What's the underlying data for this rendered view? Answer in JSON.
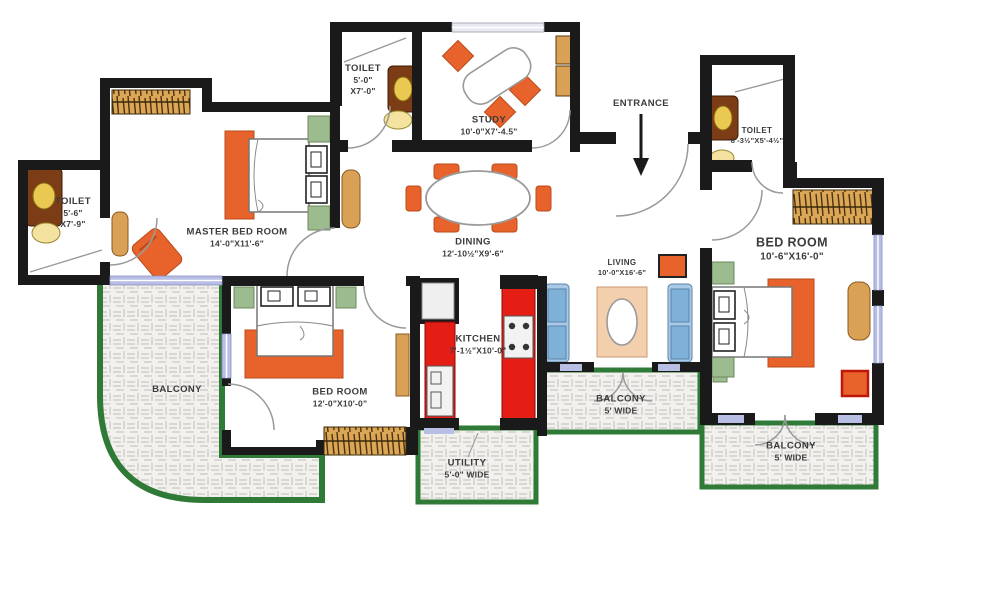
{
  "rooms": {
    "toilet_left": {
      "name": "TOILET",
      "dim_line1": "5'-6\"",
      "dim_line2": "X7'-9\""
    },
    "master_bedroom": {
      "name": "MASTER BED ROOM",
      "dim": "14'-0\"X11'-6\""
    },
    "toilet_top": {
      "name": "TOILET",
      "dim_line1": "5'-0\"",
      "dim_line2": "X7'-0\""
    },
    "study": {
      "name": "STUDY",
      "dim": "10'-0\"X7'-4.5\""
    },
    "entrance": {
      "name": "ENTRANCE"
    },
    "toilet_right": {
      "name": "TOILET",
      "dim": "8'-3½\"X5'-4½\""
    },
    "bedroom_right": {
      "name": "BED ROOM",
      "dim": "10'-6\"X16'-0\""
    },
    "dining": {
      "name": "DINING",
      "dim": "12'-10½\"X9'-6\""
    },
    "living": {
      "name": "LIVING",
      "dim": "10'-0\"X16'-6\""
    },
    "kitchen": {
      "name": "KITCHEN",
      "dim": "7'-1½\"X10'-0\""
    },
    "bedroom_left": {
      "name": "BED ROOM",
      "dim": "12'-0\"X10'-0\""
    },
    "balcony_left": {
      "name": "BALCONY"
    },
    "utility": {
      "name": "UTILITY",
      "dim": "5'-0\" WIDE"
    },
    "balcony_center": {
      "name": "BALCONY",
      "dim": "5' WIDE"
    },
    "balcony_right": {
      "name": "BALCONY",
      "dim": "5' WIDE"
    }
  },
  "colors": {
    "wall": "#1a1a1a",
    "balcony_border": "#2e7a36",
    "furniture_orange": "#e8632c",
    "counter_red": "#e41d15",
    "wood_tan": "#d9a155",
    "vanity_brown": "#7c3d16",
    "sink_yellow": "#e9c952",
    "accent_green": "#9cbb8e",
    "sofa_blue": "#a9c9e6",
    "sofa_cushion_blue": "#7fb0d8",
    "rug_peach": "#f4cfae",
    "window_lavender": "#b9bee4",
    "hatch_floor": "#f2f1ee"
  }
}
